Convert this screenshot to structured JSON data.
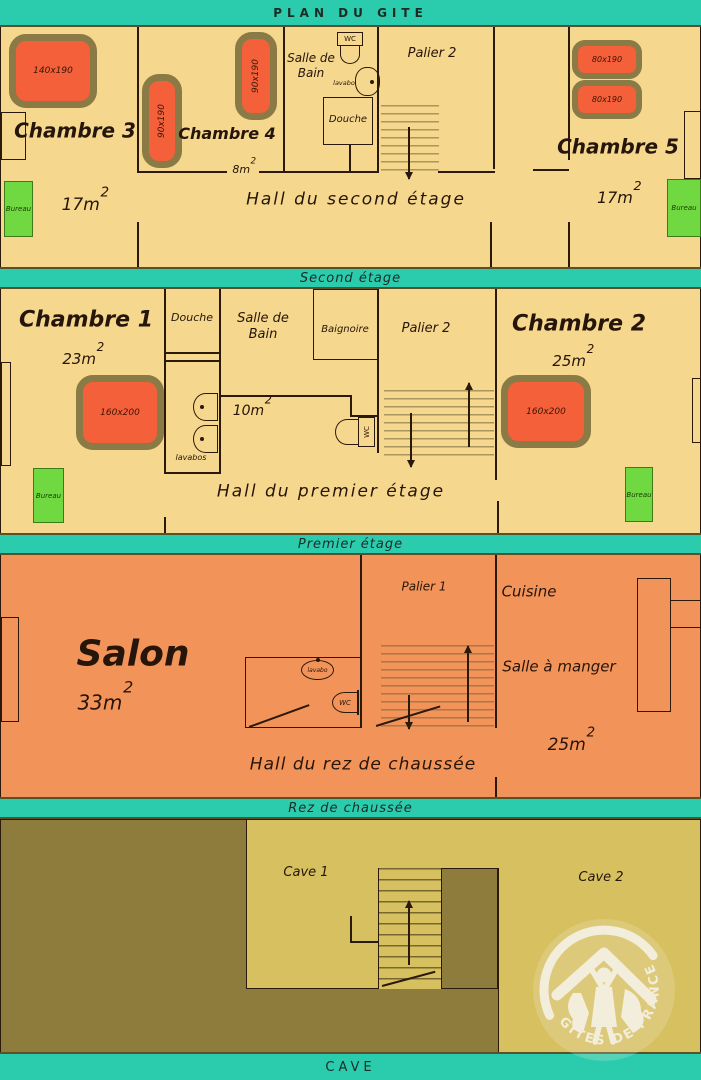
{
  "title": "PLAN DU GITE",
  "sup": "2",
  "bands": {
    "second": "Second étage",
    "premier": "Premier étage",
    "rez": "Rez de chaussée",
    "cave": "CAVE"
  },
  "floor2": {
    "chambre3": {
      "name": "Chambre 3",
      "area": "17m",
      "bed": "140x190",
      "bureau": "Bureau"
    },
    "chambre4": {
      "name": "Chambre 4",
      "area": "8m",
      "bed1": "90x190",
      "bed2": "90x190"
    },
    "bath": {
      "name1": "Salle de",
      "name2": "Bain",
      "wc": "WC",
      "lavabo": "lavabo",
      "douche": "Douche"
    },
    "palier": "Palier 2",
    "chambre5": {
      "name": "Chambre 5",
      "area": "17m",
      "bed1": "80x190",
      "bed2": "80x190",
      "bureau": "Bureau"
    },
    "hall": "Hall du second étage"
  },
  "floor1": {
    "chambre1": {
      "name": "Chambre 1",
      "area": "23m",
      "bed": "160x200",
      "bureau": "Bureau"
    },
    "douche": "Douche",
    "lavabos": "lavabos",
    "bath": {
      "name1": "Salle de",
      "name2": "Bain",
      "area": "10m"
    },
    "baignoire": "Baignoire",
    "wc": "WC",
    "palier": "Palier 2",
    "chambre2": {
      "name": "Chambre 2",
      "area": "25m",
      "bed": "160x200",
      "bureau": "Bureau"
    },
    "hall": "Hall du premier étage"
  },
  "ground": {
    "salon": {
      "name": "Salon",
      "area": "33m"
    },
    "wcroom": {
      "lavabo": "lavabo",
      "wc": "WC"
    },
    "palier": "Palier 1",
    "cuisine": "Cuisine",
    "salle": {
      "name": "Salle à manger",
      "area": "25m"
    },
    "hall": "Hall du rez de chaussée"
  },
  "cave": {
    "cave1": "Cave 1",
    "cave2": "Cave 2",
    "logo": "GÎTES DE FRANCE"
  },
  "colors": {
    "teal": "#2bcbae",
    "floor_bg": "#f5d78d",
    "ground_bg": "#f2945a",
    "cave_dark": "#8e7c3c",
    "cave_light": "#d6c05f",
    "bed_fill": "#f4603a",
    "bed_border": "#8a7a46",
    "bureau_green": "#70d840",
    "logo_cream": "#f3eddc",
    "wall": "#2b1a0c"
  }
}
